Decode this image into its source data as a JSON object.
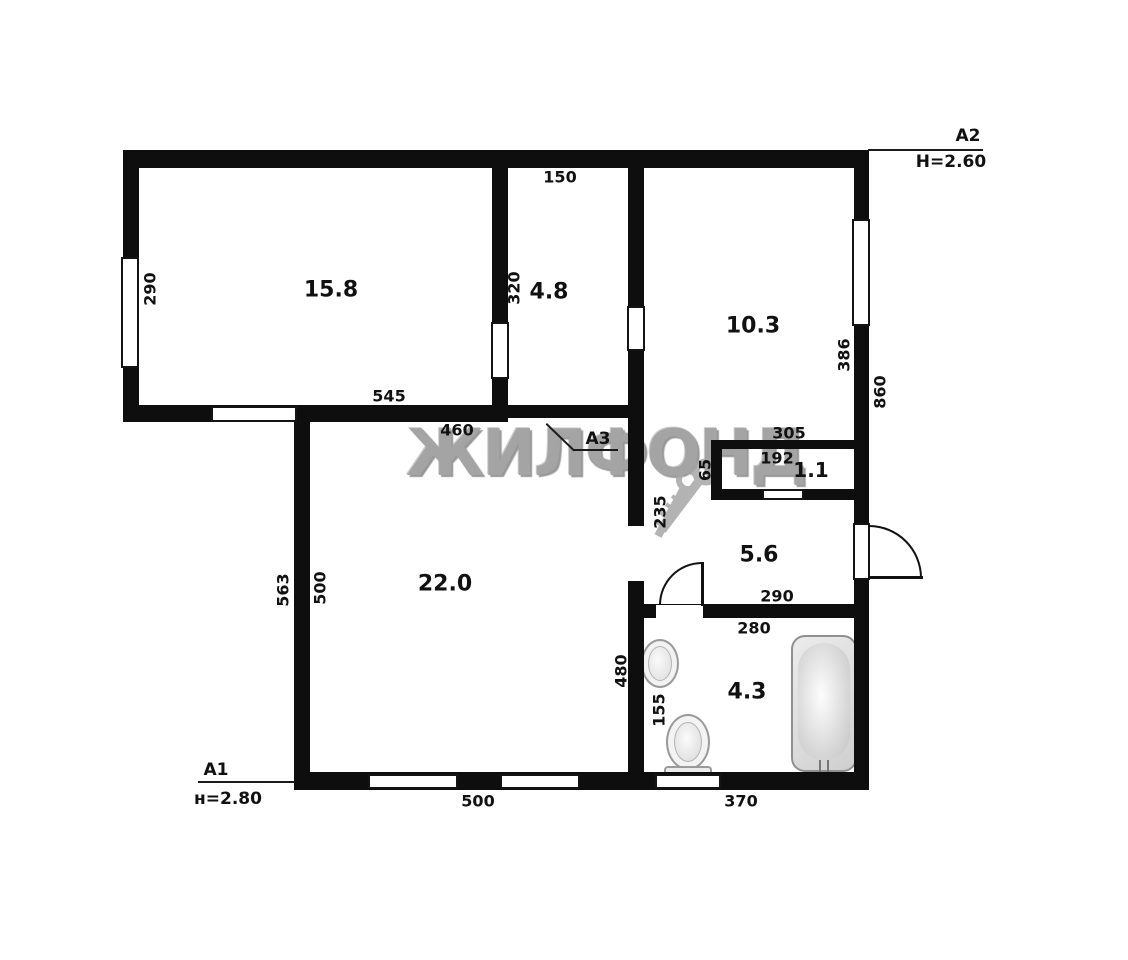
{
  "watermark": "ЖИЛФОНД",
  "markers": {
    "a1": {
      "label": "A1",
      "height": "н=2.80"
    },
    "a2": {
      "label": "A2",
      "height": "H=2.60"
    },
    "a3": {
      "label": "A3"
    }
  },
  "rooms": {
    "living": {
      "area": "15.8"
    },
    "kitchen": {
      "area": "4.8"
    },
    "bedroom": {
      "area": "10.3"
    },
    "hall": {
      "area": "22.0"
    },
    "corridor": {
      "area": "5.6"
    },
    "closet": {
      "area": "1.1"
    },
    "bathroom": {
      "area": "4.3"
    }
  },
  "dims": {
    "living_left": "290",
    "kitchen_top": "150",
    "kitchen_left": "320",
    "living_bottom": "545",
    "hall_top": "460",
    "bedroom_right": "386",
    "right_outer": "860",
    "closet_top": "305",
    "closet_inner": "192",
    "passage": "65",
    "corridor_left": "235",
    "corridor_bottom": "290",
    "bath_top": "280",
    "hall_outer_left": "563",
    "hall_left": "500",
    "bath_left": "480",
    "bath_inner": "155",
    "hall_bottom": "500",
    "bath_bottom": "370"
  }
}
